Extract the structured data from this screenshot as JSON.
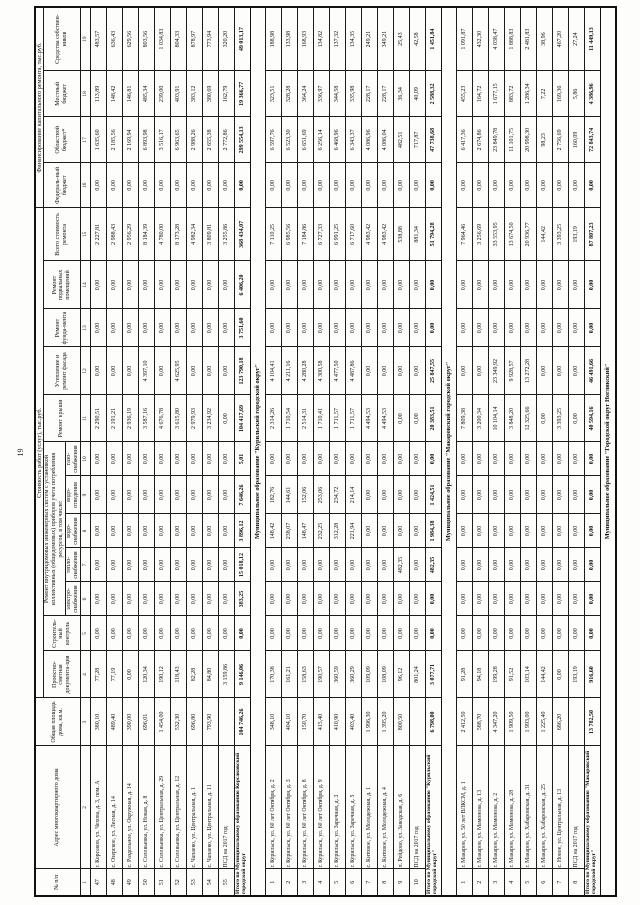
{
  "page_number": "19",
  "table": {
    "spans": {
      "cost": "Стоимость работ (услуг), тыс.руб.",
      "systems": "Ремонт внутридомовых инженерных систем с установкой коллективных (общедомовых) приборов учета потребления ресурсов, в том числе:",
      "financing": "Финансирование капитального ремонта, тыс.руб."
    },
    "columns": [
      "№ п/п",
      "Адрес многоквартирного дома",
      "Общая площадь дома, кв.м.",
      "Проектно-сметная документа-ция",
      "Строитель-ный контроль",
      "электро-снабжения",
      "тепло-снабжения",
      "водо-снабжения",
      "водо-отведения",
      "газо-снабжения",
      "Ремонт крыши",
      "Утепление и ремонт фасада",
      "Ремонт фунда-мента",
      "Ремонт подвальных помещений",
      "Всего стоимость ремонта",
      "Федераль-ный бюджет",
      "Областной бюджет*",
      "Местный бюджет",
      "Средства собствен-ников"
    ],
    "col_numbers": [
      "1",
      "2",
      "3",
      "4",
      "5",
      "6",
      "7",
      "8",
      "9",
      "10",
      "11",
      "12",
      "13",
      "14",
      "15",
      "16",
      "17",
      "18",
      "19"
    ],
    "sections": [
      {
        "title": null,
        "rows": [
          {
            "num": "47",
            "address": "г. Корсаков, ул. Чехова, д. 3, пом. А",
            "values": [
              "380,10",
              "77,28",
              "0,00",
              "0,00",
              "0,00",
              "0,00",
              "0,00",
              "0,00",
              "2 290,51",
              "0,00",
              "0,00",
              "0,00",
              "2 227,81",
              "0,00",
              "1 635,60",
              "113,89",
              "483,57"
            ]
          },
          {
            "num": "48",
            "address": "с. Озерское, ул. Лесная, д. 14",
            "values": [
              "489,40",
              "77,19",
              "0,00",
              "0,00",
              "0,00",
              "0,00",
              "0,00",
              "0,00",
              "2 191,21",
              "0,00",
              "0,00",
              "0,00",
              "2 988,43",
              "0,00",
              "2 185,56",
              "148,42",
              "636,43"
            ]
          },
          {
            "num": "49",
            "address": "с. Раздольное, ул. Окружная, д. 14",
            "values": [
              "390,00",
              "0,00",
              "0,00",
              "0,00",
              "0,00",
              "0,00",
              "0,00",
              "0,00",
              "2 936,19",
              "0,00",
              "0,00",
              "0,00",
              "2 956,29",
              "0,00",
              "2 169,94",
              "146,81",
              "629,56"
            ]
          },
          {
            "num": "50",
            "address": "с. Соловьевка, ул. Новая, д. 8",
            "values": [
              "696,01",
              "120,34",
              "0,00",
              "0,00",
              "0,00",
              "0,00",
              "0,00",
              "0,00",
              "3 587,16",
              "4 397,10",
              "0,00",
              "0,00",
              "8 184,39",
              "0,00",
              "6 893,98",
              "485,34",
              "803,56"
            ]
          },
          {
            "num": "51",
            "address": "с. Соловьевка, ул. Центральная, д. 29",
            "values": [
              "1 454,00",
              "190,12",
              "0,00",
              "0,00",
              "0,00",
              "0,00",
              "0,00",
              "0,00",
              "4 676,78",
              "0,00",
              "0,00",
              "0,00",
              "4 780,00",
              "0,00",
              "3 516,17",
              "239,00",
              "1 034,83"
            ]
          },
          {
            "num": "52",
            "address": "с. Соловьевка, ул. Центральная, д. 12",
            "values": [
              "532,30",
              "118,43",
              "0,00",
              "0,00",
              "0,00",
              "0,00",
              "0,00",
              "0,00",
              "3 615,80",
              "4 625,95",
              "0,00",
              "0,00",
              "8 173,28",
              "0,00",
              "6 963,65",
              "403,91",
              "804,33"
            ]
          },
          {
            "num": "53",
            "address": "с. Чапаево, ул. Центральная, д. 1",
            "values": [
              "696,80",
              "82,28",
              "0,00",
              "0,00",
              "0,00",
              "0,00",
              "0,00",
              "0,00",
              "2 979,93",
              "0,00",
              "0,00",
              "0,00",
              "4 982,34",
              "0,00",
              "2 988,26",
              "383,12",
              "878,97"
            ]
          },
          {
            "num": "54",
            "address": "с. Чапаево, ул. Центральная, д. 11",
            "values": [
              "793,90",
              "84,80",
              "0,00",
              "0,00",
              "0,00",
              "0,00",
              "0,00",
              "0,00",
              "3 234,92",
              "0,00",
              "0,00",
              "0,00",
              "3 809,81",
              "0,00",
              "2 655,38",
              "380,69",
              "773,94"
            ]
          },
          {
            "num": "55",
            "address": "ПСД на 2017 год",
            "values": [
              "",
              "3 159,86",
              "0,00",
              "0,00",
              "0,00",
              "0,00",
              "0,00",
              "0,00",
              "0,00",
              "0,00",
              "0,00",
              "0,00",
              "3 255,86",
              "0,00",
              "2 772,86",
              "162,79",
              "320,20"
            ]
          }
        ],
        "total": {
          "label": "Итого по Муниципальному образованию Корсаковский городской округ",
          "values": [
            "104 746,26",
            "9 146,06",
            "0,00",
            "383,25",
            "15 018,12",
            "3 896,12",
            "7 646,26",
            "5,01",
            "104 417,69",
            "123 790,18",
            "3 751,60",
            "6 406,20",
            "368 434,07",
            "0,00",
            "299 554,13",
            "19 366,77",
            "49 013,17"
          ]
        }
      },
      {
        "title": "Муниципальное образование \"Курильский городской округ\"",
        "rows": [
          {
            "num": "1",
            "address": "г. Курильск, ул. 60 лет Октября, д. 2",
            "values": [
              "348,10",
              "170,38",
              "0,00",
              "0,00",
              "0,00",
              "148,42",
              "182,76",
              "0,00",
              "2 314,26",
              "4 104,41",
              "0,00",
              "0,00",
              "7 110,25",
              "0,00",
              "6 597,76",
              "323,51",
              "188,98"
            ]
          },
          {
            "num": "2",
            "address": "г. Курильск, ул. 60 лет Октября, д. 3",
            "values": [
              "404,10",
              "161,21",
              "0,00",
              "0,00",
              "0,00",
              "238,07",
              "144,61",
              "0,00",
              "1 710,54",
              "4 211,16",
              "0,00",
              "0,00",
              "6 985,56",
              "0,00",
              "6 523,30",
              "328,28",
              "133,98"
            ]
          },
          {
            "num": "3",
            "address": "г. Курильск, ул. 60 лет Октября, д. 8",
            "values": [
              "150,70",
              "158,63",
              "0,00",
              "0,00",
              "0,00",
              "148,47",
              "152,06",
              "0,00",
              "2 514,31",
              "4 280,28",
              "0,00",
              "0,00",
              "7 184,86",
              "0,00",
              "6 651,69",
              "364,24",
              "168,93"
            ]
          },
          {
            "num": "4",
            "address": "г. Курильск, ул. 60 лет Октября, д. 9",
            "values": [
              "415,40",
              "190,57",
              "0,00",
              "0,00",
              "0,00",
              "232,25",
              "253,06",
              "0,00",
              "1 710,41",
              "4 300,58",
              "0,00",
              "0,00",
              "6 727,33",
              "0,00",
              "6 256,14",
              "336,97",
              "134,82"
            ]
          },
          {
            "num": "5",
            "address": "г. Курильск, ул. Заречная, д. 3",
            "values": [
              "410,90",
              "360,59",
              "0,00",
              "0,00",
              "0,00",
              "312,28",
              "234,72",
              "0,00",
              "1 711,57",
              "4 477,50",
              "0,00",
              "0,00",
              "6 991,25",
              "0,00",
              "6 468,96",
              "344,58",
              "137,32"
            ]
          },
          {
            "num": "6",
            "address": "г. Курильск, ул. Заречная, д. 5",
            "values": [
              "403,40",
              "360,29",
              "0,00",
              "0,00",
              "0,00",
              "221,94",
              "214,14",
              "0,00",
              "1 711,57",
              "4 487,86",
              "0,00",
              "0,00",
              "6 717,60",
              "0,00",
              "6 343,37",
              "335,98",
              "134,35"
            ]
          },
          {
            "num": "7",
            "address": "с. Китовое, ул. Молодежная, д. 1",
            "values": [
              "1 996,30",
              "109,09",
              "0,00",
              "0,00",
              "0,00",
              "0,00",
              "0,00",
              "0,00",
              "4 494,53",
              "0,00",
              "0,00",
              "0,00",
              "4 983,42",
              "0,00",
              "4 086,96",
              "228,17",
              "249,21"
            ]
          },
          {
            "num": "8",
            "address": "с. Китовое, ул. Молодежная, д. 4",
            "values": [
              "1 395,20",
              "108,09",
              "0,00",
              "0,00",
              "0,00",
              "0,00",
              "0,00",
              "0,00",
              "4 494,53",
              "0,00",
              "0,00",
              "0,00",
              "4 983,42",
              "0,00",
              "4 086,04",
              "228,17",
              "349,21"
            ]
          },
          {
            "num": "9",
            "address": "п. Рейдово, ул. Заводская, д. 6",
            "values": [
              "800,50",
              "96,12",
              "0,00",
              "0,00",
              "482,35",
              "0,00",
              "0,00",
              "0,00",
              "0,00",
              "0,00",
              "0,00",
              "0,00",
              "538,88",
              "0,00",
              "482,51",
              "36,34",
              "25,43"
            ]
          },
          {
            "num": "10",
            "address": "ПСД на 2017 год",
            "values": [
              "",
              "801,24",
              "0,00",
              "0,00",
              "0,00",
              "0,00",
              "0,00",
              "0,00",
              "0,00",
              "0,00",
              "0,00",
              "0,00",
              "881,34",
              "0,00",
              "717,87",
              "40,09",
              "42,58"
            ]
          }
        ],
        "total": {
          "label": "Итого по Муниципальному образованию \"Курильский городской округ\"",
          "values": [
            "6 798,00",
            "3 077,71",
            "0,00",
            "0,00",
            "482,35",
            "1 984,38",
            "1 424,51",
            "0,00",
            "20 383,51",
            "25 847,55",
            "0,00",
            "0,00",
            "51 794,28",
            "0,00",
            "47 738,68",
            "2 588,32",
            "1 451,84"
          ]
        }
      },
      {
        "title": "Муниципальное образование \"Макаровский городской округ\"",
        "rows": [
          {
            "num": "1",
            "address": "г. Макаров, ул. 50 лет ВЛКСМ, д. 1",
            "values": [
              "2 412,50",
              "91,28",
              "0,00",
              "0,00",
              "0,00",
              "0,00",
              "0,00",
              "0,00",
              "7 809,38",
              "0,00",
              "0,00",
              "0,00",
              "7 964,46",
              "0,00",
              "6 417,36",
              "455,23",
              "1 091,87"
            ]
          },
          {
            "num": "2",
            "address": "г. Макаров, ул. Мамонова, д. 13",
            "values": [
              "588,70",
              "94,18",
              "0,00",
              "0,00",
              "0,00",
              "0,00",
              "0,00",
              "0,00",
              "3 200,34",
              "0,00",
              "0,00",
              "0,00",
              "3 256,69",
              "0,00",
              "2 674,86",
              "164,72",
              "432,30"
            ]
          },
          {
            "num": "3",
            "address": "г. Макаров, ул. Мамонова, д. 2",
            "values": [
              "4 347,20",
              "199,28",
              "0,00",
              "0,00",
              "0,00",
              "0,00",
              "0,00",
              "0,00",
              "10 104,14",
              "23 349,92",
              "0,00",
              "0,00",
              "33 553,95",
              "0,00",
              "23 849,78",
              "1 677,15",
              "4 038,47"
            ]
          },
          {
            "num": "4",
            "address": "г. Макаров, ул. Мамонова, д. 28",
            "values": [
              "1 909,50",
              "91,52",
              "0,00",
              "0,00",
              "0,00",
              "0,00",
              "0,00",
              "0,00",
              "3 848,20",
              "9 928,57",
              "0,00",
              "0,00",
              "13 674,50",
              "0,00",
              "11 101,75",
              "883,72",
              "1 888,83"
            ]
          },
          {
            "num": "5",
            "address": "г. Макаров, ул. Хабаровская, д. 31",
            "values": [
              "1 993,00",
              "103,14",
              "0,00",
              "0,00",
              "0,00",
              "0,00",
              "0,00",
              "0,00",
              "12 325,66",
              "13 272,28",
              "0,00",
              "0,00",
              "20 936,77",
              "0,00",
              "20 998,30",
              "1 286,34",
              "2 481,83"
            ]
          },
          {
            "num": "6",
            "address": "г. Макаров, ул. Хабаровская, д. 25",
            "values": [
              "1 225,40",
              "144,42",
              "0,00",
              "0,00",
              "0,00",
              "0,00",
              "0,00",
              "0,00",
              "0,00",
              "0,00",
              "0,00",
              "0,00",
              "144,42",
              "0,00",
              "98,23",
              "7,22",
              "38,96"
            ]
          },
          {
            "num": "7",
            "address": "с. Новое, ул. Центральная, д. 13",
            "values": [
              "686,20",
              "0,00",
              "0,00",
              "0,00",
              "0,00",
              "0,00",
              "0,00",
              "0,00",
              "3 393,25",
              "0,00",
              "0,00",
              "0,00",
              "3 393,25",
              "0,00",
              "2 756,69",
              "169,36",
              "467,20"
            ]
          },
          {
            "num": "8",
            "address": "ПСД на 2017 год",
            "values": [
              "",
              "193,19",
              "0,00",
              "0,00",
              "0,00",
              "0,00",
              "0,00",
              "0,00",
              "0,00",
              "0,00",
              "0,00",
              "0,00",
              "193,19",
              "0,00",
              "160,09",
              "5,86",
              "27,24"
            ]
          }
        ],
        "total": {
          "label": "Итого по Муниципальному образованию \"Макаровский городской округ\"",
          "values": [
            "13 782,50",
            "916,60",
            "0,00",
            "0,00",
            "0,00",
            "0,00",
            "0,00",
            "0,00",
            "40 594,16",
            "46 491,66",
            "0,00",
            "0,00",
            "87 807,23",
            "0,00",
            "72 843,74",
            "4 386,96",
            "11 449,13"
          ]
        }
      }
    ],
    "next_section_title": "Муниципальное образование \"Городской округ Ногликский\""
  }
}
